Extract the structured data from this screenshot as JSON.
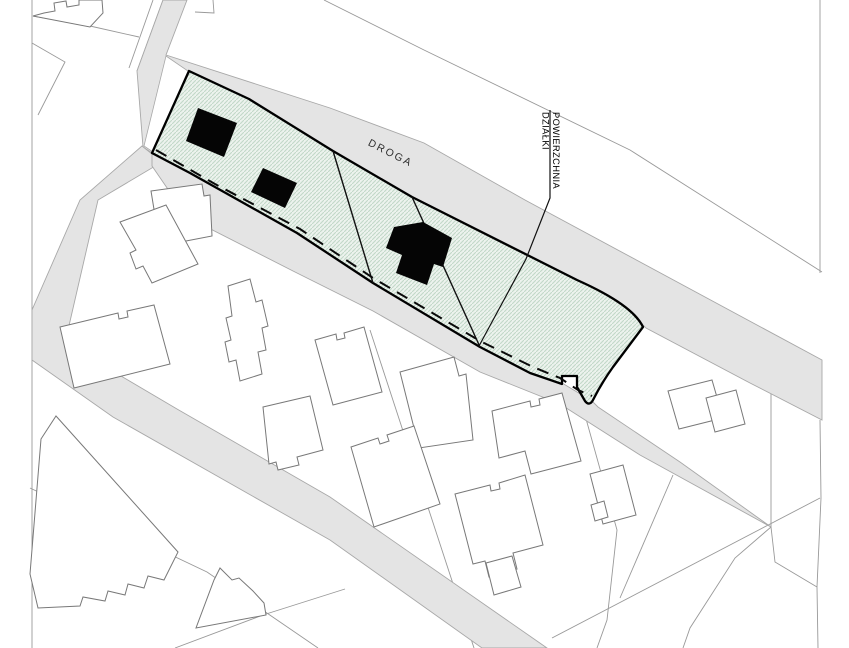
{
  "document": {
    "type": "cadastral-site-plan",
    "orientation": "roads run diagonally from upper-left to lower-right"
  },
  "labels": {
    "road": "DROGA",
    "parcel_area_line1": "POWIERZCHNIA",
    "parcel_area_line2": "DZIAŁKI"
  },
  "parcel": {
    "label": "POWIERZCHNIA DZIAŁKI",
    "sublots": 3,
    "black_building_footprints": 3,
    "has_dashed_line_along_south_boundary": true,
    "fill": "green diagonal hatch"
  },
  "colors": {
    "background": "#ffffff",
    "road_fill": "#e4e4e4",
    "road_edge": "#a8a8a8",
    "boundary_line": "#999999",
    "building_outline": "#787878",
    "parcel_outline": "#000000",
    "parcel_hatch_line": "#c2d8c8",
    "parcel_hatch_bg": "#edf3ee",
    "building_footprint": "#050505",
    "label_text": "#2f2f2f"
  }
}
